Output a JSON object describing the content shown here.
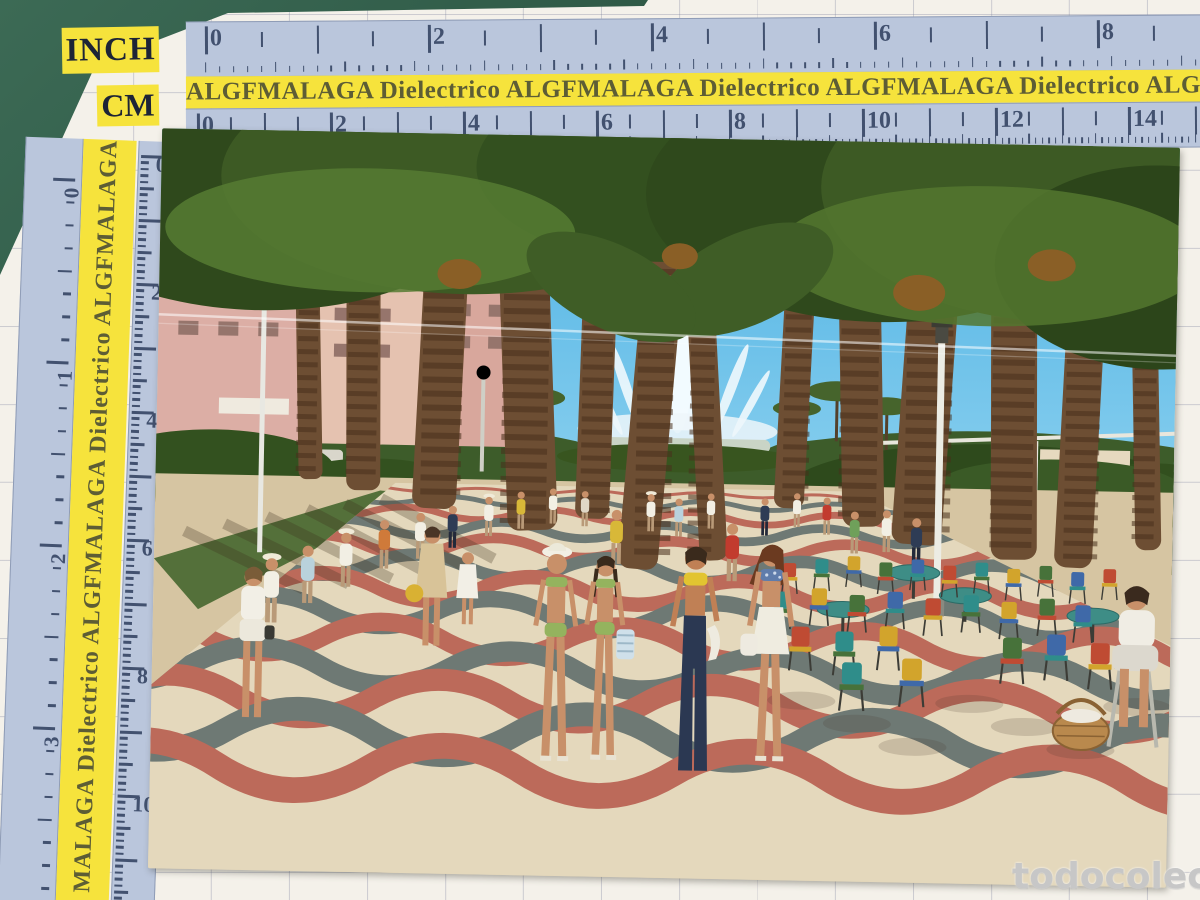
{
  "labels": {
    "inch": "INCH",
    "cm": "CM"
  },
  "band": {
    "horizontal_text": "ALGFMALAGA  Dielectrico  ALGFMALAGA  Dielectrico  ALGFMALAGA  Dielectrico  ALGFMALAGA",
    "vertical_text": "MALAGA  Dielectrico  ALGFMALAGA  Dielectrico  ALGFMALAGA"
  },
  "rulers": {
    "top_inch_numbers": [
      "0",
      "2",
      "4",
      "6",
      "8"
    ],
    "top_cm_numbers": [
      "0",
      "2",
      "4",
      "6",
      "8",
      "10",
      "12",
      "14"
    ],
    "left_inch_numbers": [
      "0",
      "1",
      "2",
      "3"
    ],
    "left_cm_numbers": [
      "0",
      "2",
      "4",
      "6",
      "8",
      "10"
    ]
  },
  "watermark": {
    "site": "todocoleccion"
  },
  "colors": {
    "mat_green": "#3c6a55",
    "paper": "#f4f1ea",
    "ruler_blue": "#bac6dc",
    "ruler_ink": "#42516f",
    "band_yellow": "#f6e33c",
    "band_ink": "#5d5d35",
    "sky_top": "#47aee2",
    "sky_low": "#90d3f0",
    "palm_dark": "#2f491c",
    "palm_mid": "#3d5a24",
    "palm_light": "#567b33",
    "trunk": "#6d4e33",
    "pave_cream": "#e4d8bc",
    "pave_red": "#bc6a5a",
    "pave_gray": "#6e7974",
    "lane_tan": "#d6c5a2",
    "watermark_gray": "#c7c7c7",
    "chair_palette": [
      "#bf4b33",
      "#2f8d8a",
      "#d2a42c",
      "#47723a",
      "#3f69a8"
    ],
    "crowd_shirts": [
      "#f2efe4",
      "#d8b838",
      "#c23b2e",
      "#cf7a3a",
      "#b9d2dc",
      "#2e3c55",
      "#6fa05a",
      "#e0d7c6"
    ]
  }
}
